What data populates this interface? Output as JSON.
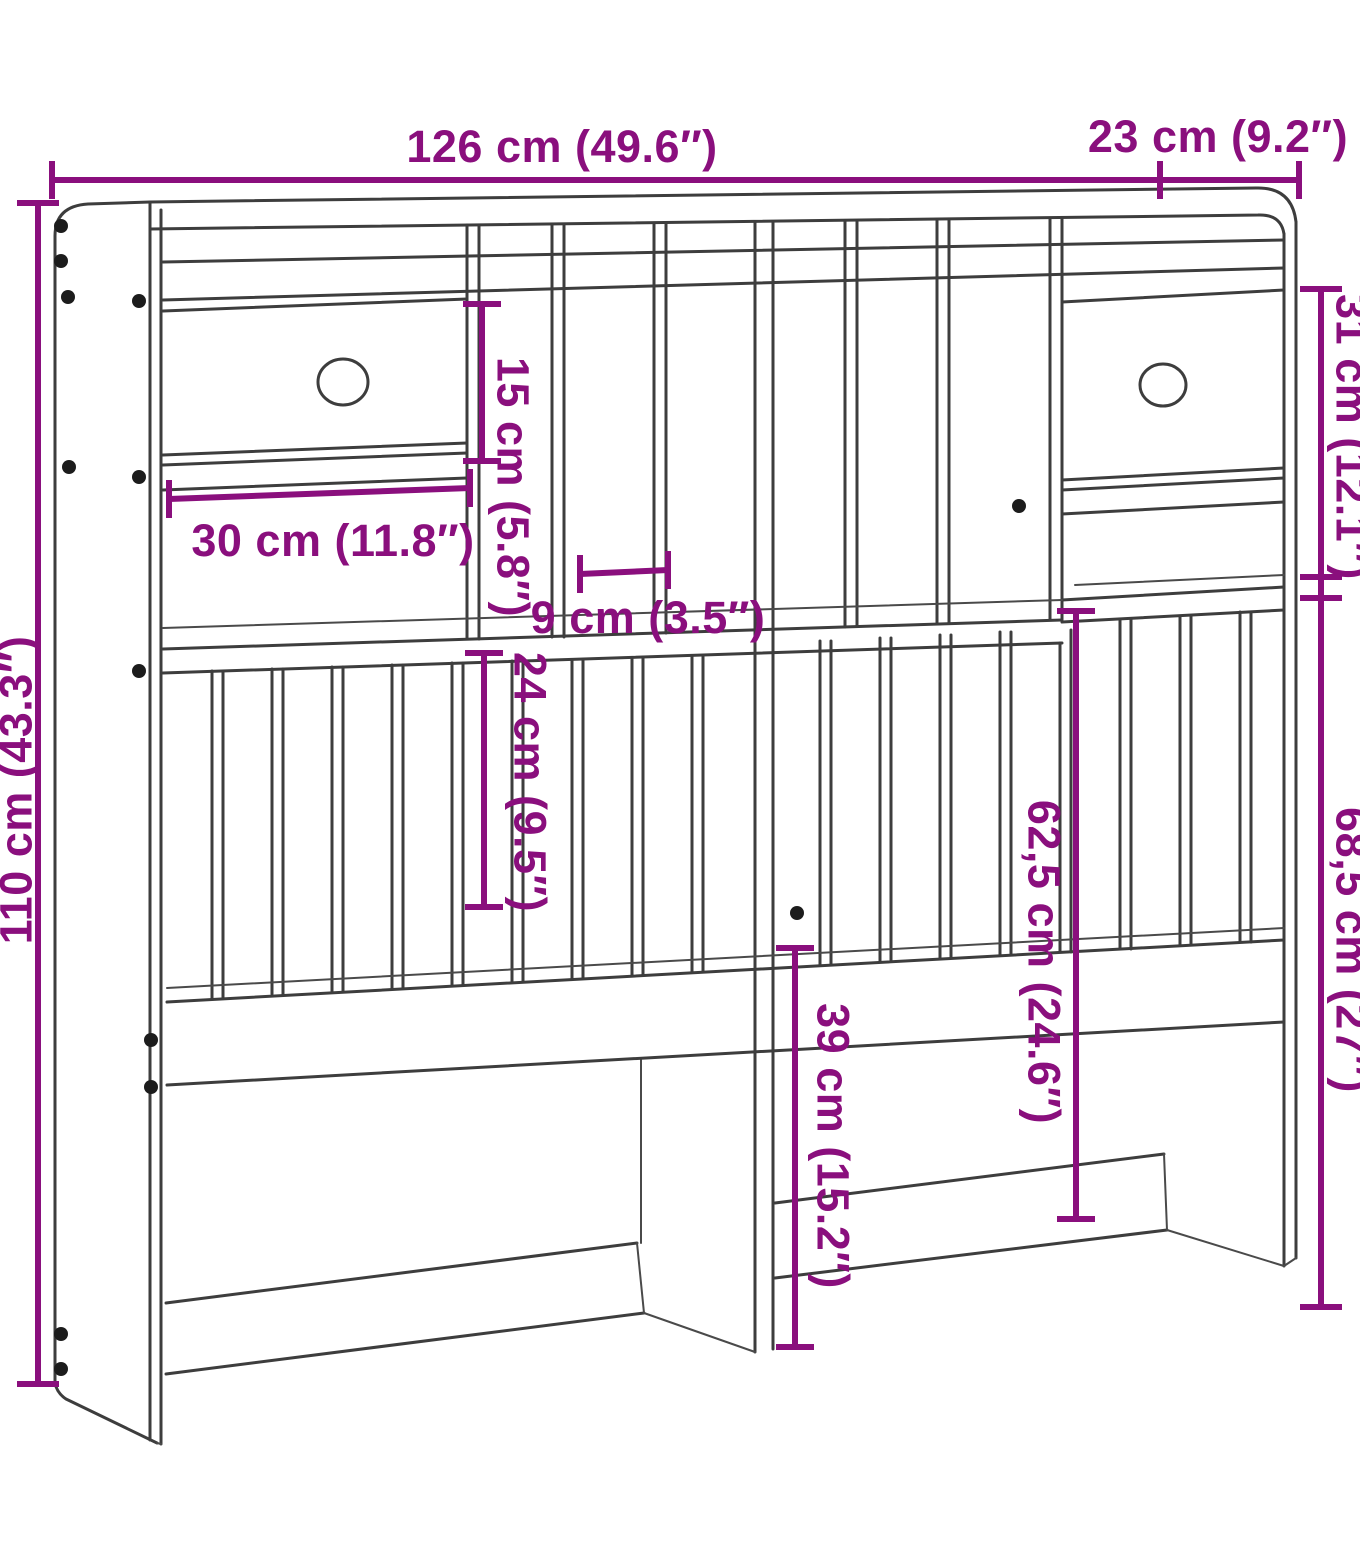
{
  "diagram": {
    "type": "furniture-dimension-drawing",
    "subject": "headboard-with-storage",
    "colors": {
      "dimension": "#8a0f7d",
      "line": "#3d3d3d",
      "background": "#ffffff"
    },
    "dimensions": {
      "overall_width": "126 cm (49.6″)",
      "top_depth": "23 cm (9.2″)",
      "overall_height": "110 cm (43.3″)",
      "upper_right_height": "31 cm (12.1″)",
      "lower_right_height": "68,5 cm (27″)",
      "drawer_compartment_height": "15 cm (5.8″)",
      "drawer_width": "30 cm (11.8″)",
      "slot_width": "9 cm (3.5″)",
      "slat_section_height": "24 cm (9.5″)",
      "mid_section_height": "62,5 cm (24.6″)",
      "bottom_clearance_height": "39 cm (15.2″)"
    }
  }
}
